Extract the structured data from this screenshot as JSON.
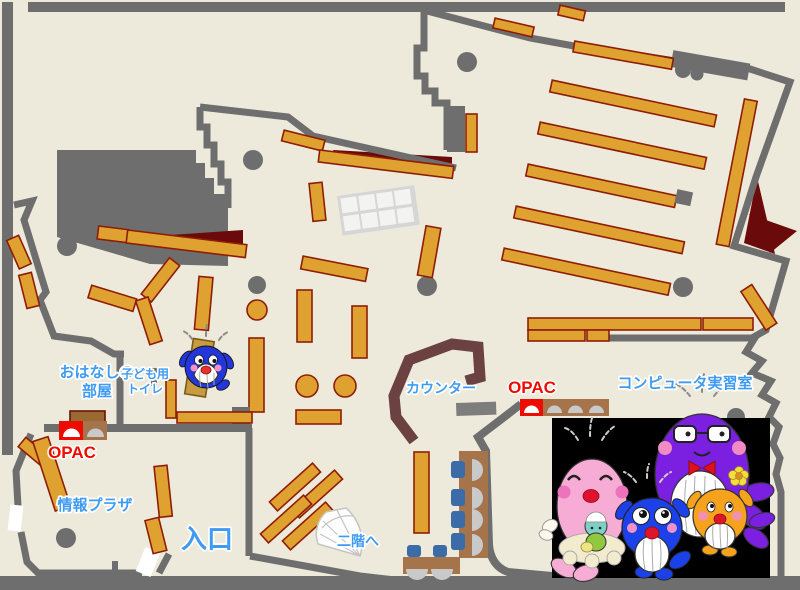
{
  "map": {
    "title": "library-first-floor-map",
    "labels": {
      "storytelling_1": "おはなしの",
      "storytelling_2": "部屋",
      "toilet_1": "子ども用",
      "toilet_2": "トイレ",
      "opac_left": "OPAC",
      "opac_center": "OPAC",
      "info_plaza": "情報プラザ",
      "entrance": "入口",
      "stairs": "二階へ",
      "counter": "カウンター",
      "computer_room": "コンピュータ実習室"
    },
    "colors": {
      "floor": "#EDEADB",
      "wall": "#6E6E6E",
      "shelf": "#DFA231",
      "shelf_border": "#8F1D06",
      "accent_dark_red": "#6B0A0A",
      "counter_brown": "#6B4141",
      "desk_brown": "#A5744B",
      "chair_blue": "#3B6CA8",
      "chair_gray": "#C9C9C9",
      "opac_red": "#EE0B00",
      "label_blue": "#3F9BF2",
      "photo_background": "#000000"
    },
    "mascots": {
      "floor_mascot": "blue-whale-mascot",
      "photo_mascots": [
        "pink-whale-with-baby",
        "blue-whale",
        "purple-whale-with-glasses",
        "orange-whale-with-flower"
      ]
    }
  }
}
